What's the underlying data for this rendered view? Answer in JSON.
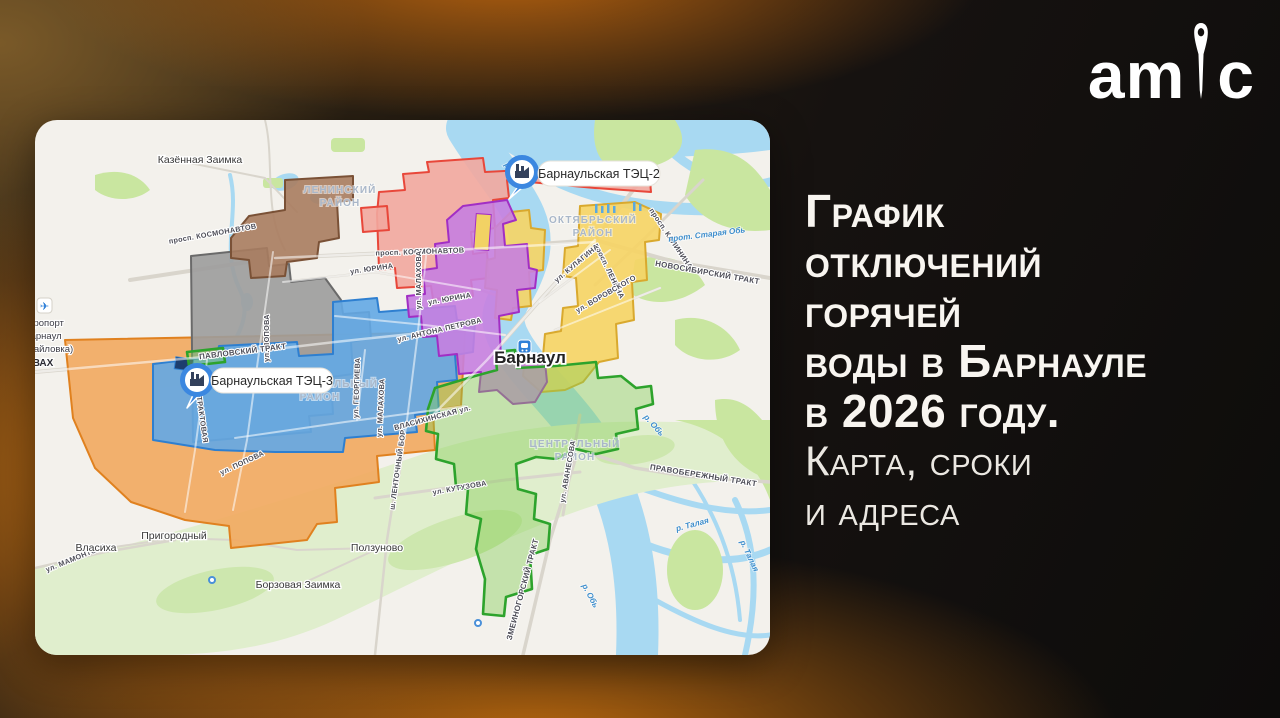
{
  "brand": {
    "logo_left": "am",
    "logo_right": "c"
  },
  "headline": {
    "title_lines": [
      "График",
      "отключений",
      "горячей",
      "воды в Барнауле",
      "в 2026 году."
    ],
    "subtitle_lines": [
      "Карта, сроки",
      "и адреса"
    ]
  },
  "map": {
    "city_label": "Барнаул",
    "markers": [
      {
        "label": "Барнаульская ТЭЦ-2"
      },
      {
        "label": "Барнаульская ТЭЦ-3"
      }
    ],
    "airport": {
      "lines": [
        "Аэропорт",
        "Барнаул",
        "(Михайловка)",
        "ВАХ"
      ]
    },
    "districts": [
      {
        "line1": "ЛЕНИНСКИЙ",
        "line2": "РАЙОН"
      },
      {
        "line1": "ОКТЯБРЬСКИЙ",
        "line2": "РАЙОН"
      },
      {
        "line1": "ИНДУСТРИАЛЬНЫЙ",
        "line2": "РАЙОН"
      },
      {
        "line1": "ЦЕНТРАЛЬНЫЙ",
        "line2": "РАЙОН"
      }
    ],
    "settlements": [
      "Казённая Заимка",
      "Власиха",
      "Пригородный",
      "Ползуново",
      "Борзовая Заимка"
    ],
    "water_labels": [
      "р. Обь",
      "прот. Старая Обь",
      "р. Обь",
      "р. Обь",
      "р. Талая",
      "р. Талая"
    ],
    "street_labels": [
      "просп. КОСМОНАВТОВ",
      "просп. КОСМОНАВТОВ",
      "ул. ПОПОВА",
      "ул. ПОПОВА",
      "ул. ЮРИНА",
      "ул. ЮРИНА",
      "ул. МАЛАХОВА",
      "ул. МАЛАХОВА",
      "ул. ГЕОРГИЕВА",
      "ул. АНТОНА ПЕТРОВА",
      "просп. ЛЕНИНА",
      "просп. КАЛИНИНА",
      "ул. КУЛАГИНА",
      "ул. ВОРОВСКОГО",
      "НОВОСИБИРСКИЙ ТРАКТ",
      "ПАВЛОВСКИЙ ТРАКТ",
      "ТРАКТОВАЯ",
      "ВЛАСИХИНСКАЯ ул.",
      "ул. МАМОНТОВА",
      "ул. КУТУЗОВА",
      "ул. АВАНЕСОВА",
      "ПРАВОБЕРЕЖНЫЙ ТРАКТ",
      "ЗМЕИНОГОРСКИЙ ТРАКТ",
      "ш. ЛЕНТОЧНЫЙ БОР"
    ],
    "zone_colors": {
      "red": {
        "fill": "#f2a79e",
        "stroke": "#e8473a"
      },
      "brown": {
        "fill": "#a97c5f",
        "stroke": "#7a5136"
      },
      "gray": {
        "fill": "#9c9c9c",
        "stroke": "#6a6a6a"
      },
      "blue": {
        "fill": "#63a9e6",
        "stroke": "#2e7fd0"
      },
      "purple": {
        "fill": "#c77fe0",
        "stroke": "#a22ec4"
      },
      "yellow": {
        "fill": "#f6d464",
        "stroke": "#d9a92e"
      },
      "orange": {
        "fill": "#f2a95f",
        "stroke": "#e0811f"
      },
      "green": {
        "fill": "rgba(132,204,84,0.42)",
        "stroke": "#2da32c"
      }
    }
  }
}
